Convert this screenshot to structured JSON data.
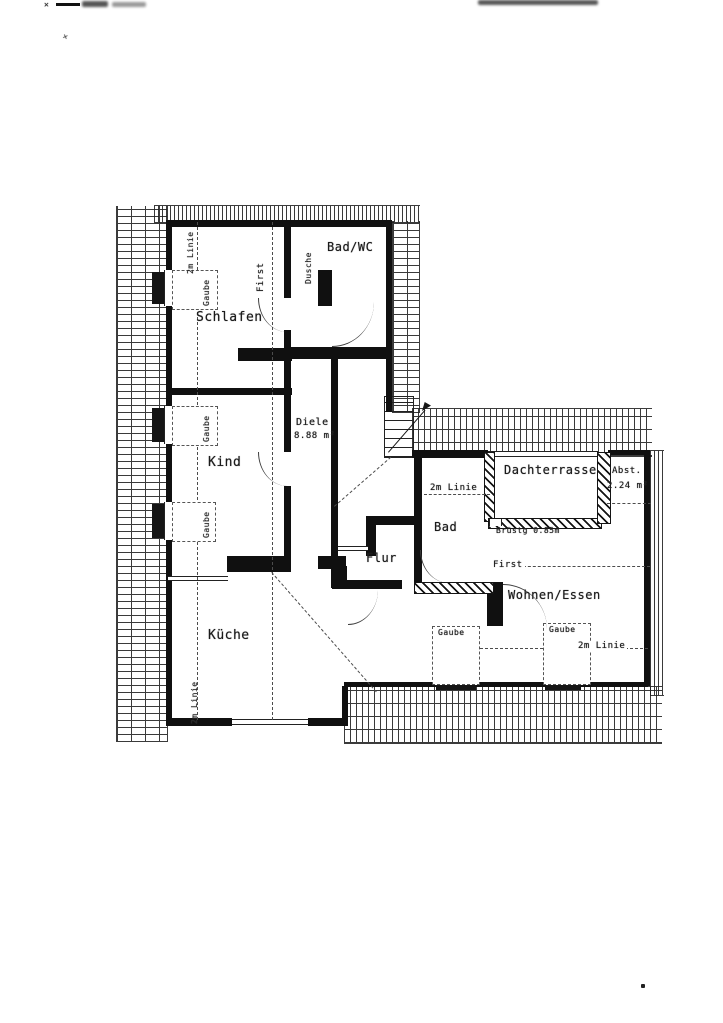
{
  "page": {
    "paper_color": "#ffffff",
    "ink_color": "#1a1a1a"
  },
  "rooms": {
    "schlafen": {
      "label": "Schlafen"
    },
    "bad_wc": {
      "label": "Bad/WC"
    },
    "kind": {
      "label": "Kind"
    },
    "diele": {
      "label": "Diele",
      "area": "8.88 m²"
    },
    "kueche": {
      "label": "Küche"
    },
    "flur": {
      "label": "Flur"
    },
    "bad": {
      "label": "Bad"
    },
    "dachterrasse": {
      "label": "Dachterrasse"
    },
    "abstellraum": {
      "label": "Abst.",
      "area": "2.24 m²"
    },
    "wohnen_essen": {
      "label": "Wohnen/Essen"
    }
  },
  "annotations": {
    "first": "First",
    "two_m_line": "2m Linie",
    "gaube": "Gaube",
    "dusche": "Dusche",
    "parapet": "Brüstg 0.85m"
  },
  "artifacts": {
    "x_mark": "✕",
    "dot": "·"
  }
}
